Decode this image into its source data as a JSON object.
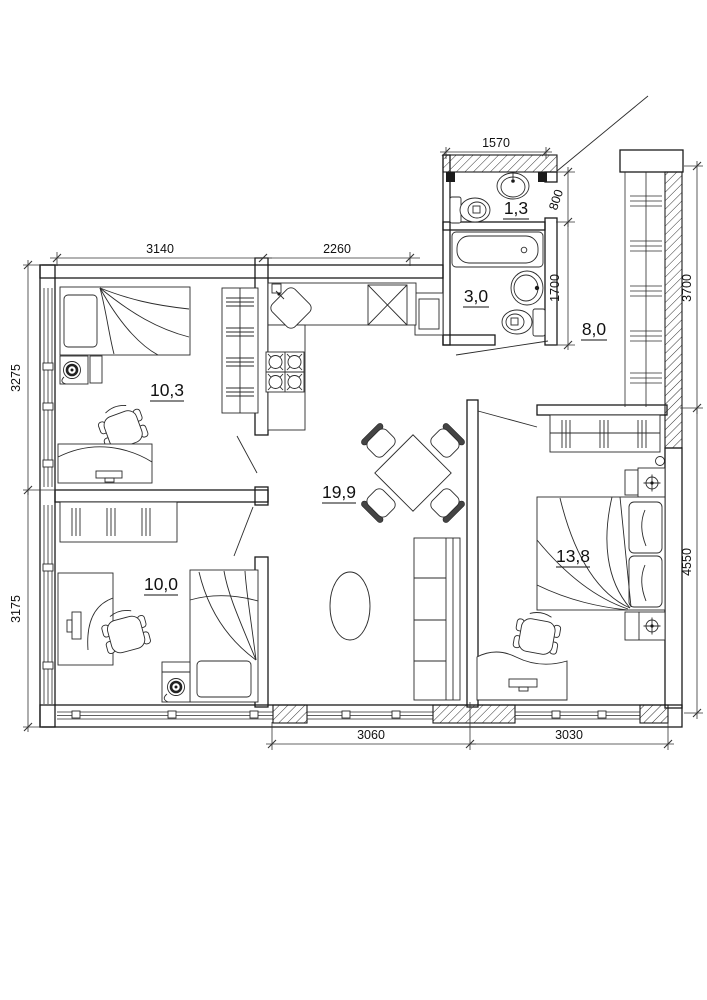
{
  "plan": {
    "rooms": {
      "wc": {
        "area": "1,3"
      },
      "bathroom": {
        "area": "3,0"
      },
      "hall": {
        "area": "8,0"
      },
      "bedroom_top_left": {
        "area": "10,3"
      },
      "living_kitchen": {
        "area": "19,9"
      },
      "bedroom_bottom_left": {
        "area": "10,0"
      },
      "bedroom_right": {
        "area": "13,8"
      }
    },
    "dimensions": {
      "wc_width": "1570",
      "bedroom_top_width": "3140",
      "kitchen_width": "2260",
      "left_upper_height": "3275",
      "left_lower_height": "3175",
      "wc_height": "800",
      "bathroom_height": "1700",
      "loggia_height": "3700",
      "bedroom_right_height": "4550",
      "bottom_left_width": "3060",
      "bottom_right_width": "3030"
    }
  }
}
